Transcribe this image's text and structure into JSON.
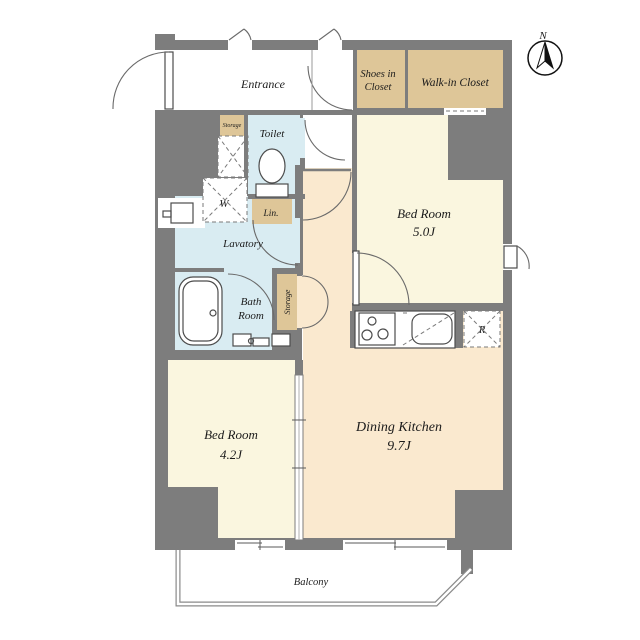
{
  "plan": {
    "rooms": {
      "entrance": {
        "label": "Entrance"
      },
      "shoes_closet": {
        "line1": "Shoes in",
        "line2": "Closet"
      },
      "walk_in_closet": {
        "label": "Walk-in Closet"
      },
      "bedroom_right": {
        "name": "Bed Room",
        "size": "5.0J"
      },
      "bedroom_left": {
        "name": "Bed Room",
        "size": "4.2J"
      },
      "dining_kitchen": {
        "name": "Dining Kitchen",
        "size": "9.7J"
      },
      "toilet": {
        "label": "Toilet"
      },
      "lavatory": {
        "label": "Lavatory"
      },
      "bath_room": {
        "line1": "Bath",
        "line2": "Room"
      },
      "balcony": {
        "label": "Balcony"
      }
    },
    "storage": {
      "entry_storage": {
        "label": "Storage"
      },
      "hall_storage": {
        "label": "Storage"
      },
      "linen": {
        "label": "Lin."
      }
    },
    "appliances": {
      "washer": {
        "label": "W"
      },
      "refrigerator": {
        "label": "R"
      }
    },
    "compass": {
      "label": "N"
    },
    "colors": {
      "wall": "#7d7d7d",
      "room_cream": "#faf6df",
      "room_peach": "#fae9cf",
      "closet_tan": "#dec698",
      "wet_blue": "#d9ecf2",
      "outline": "#4c4c4c"
    }
  }
}
